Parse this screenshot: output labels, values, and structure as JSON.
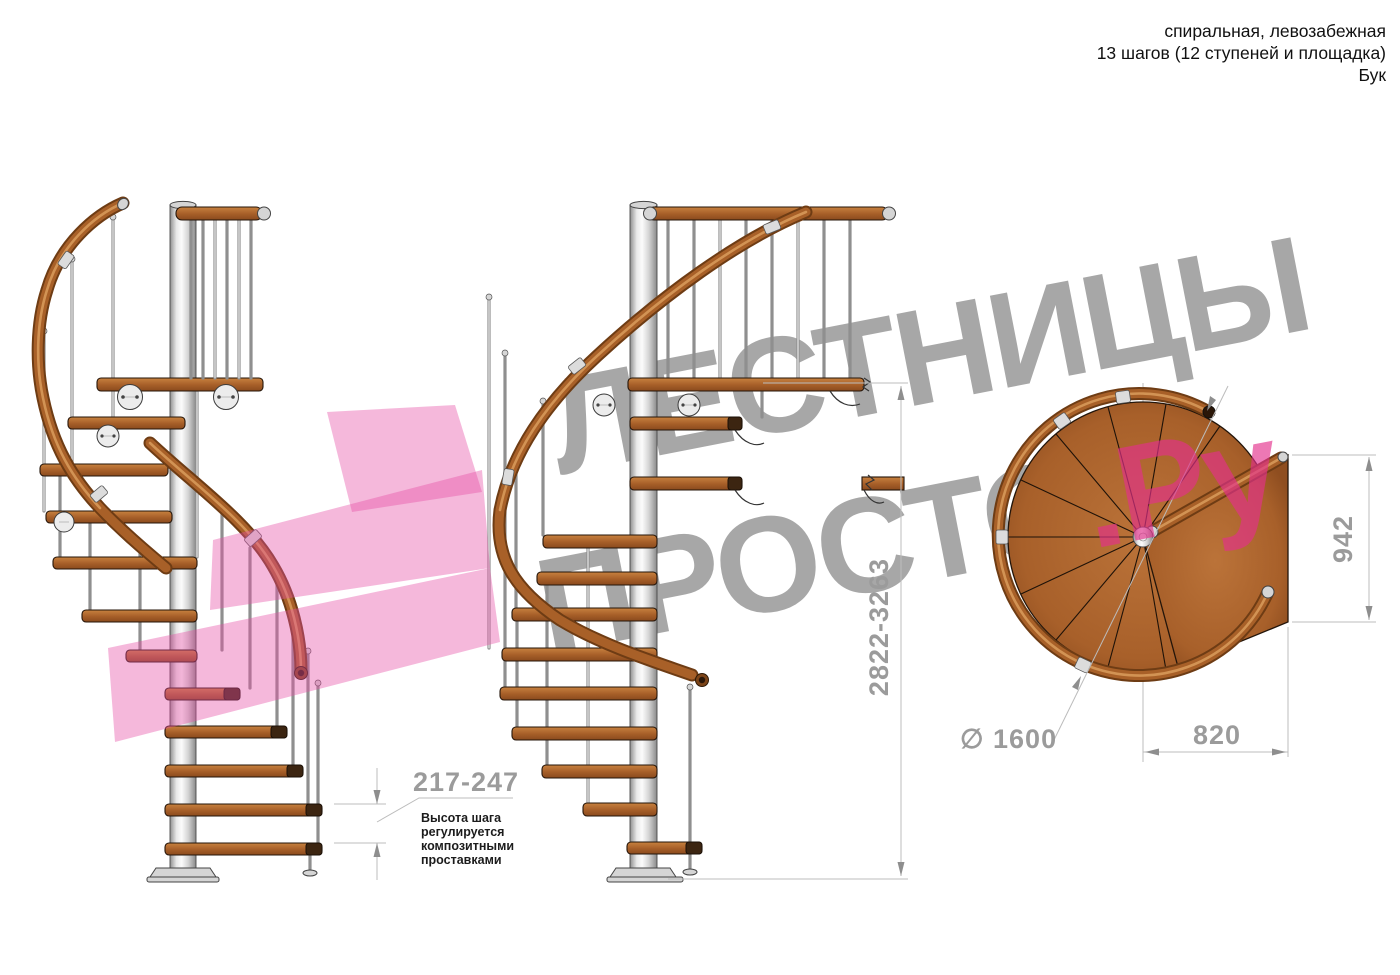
{
  "header": {
    "line1": "спиральная, левозабежная",
    "line2": "13 шагов (12 ступеней и площадка)",
    "line3": "Бук"
  },
  "watermark": {
    "line1": "ЛЕСТНИЦЫ",
    "line2_gray": "ПРОСТО",
    "line2_pink": ".Ру"
  },
  "dimensions": {
    "total_height": "2822-3263",
    "step_height": "217-247",
    "step_note_lines": [
      "Высота шага",
      "регулируется",
      "композитными",
      "проставками"
    ],
    "plan_width": "942",
    "plan_depth": "820",
    "diameter": "∅ 1600"
  },
  "colors": {
    "wood": "#a9632d",
    "metal": "#d9d9d9",
    "dimension_gray": "#9b9b9b",
    "watermark_gray": "#a8a8a8",
    "watermark_pink": "#ee7fb8",
    "background": "#ffffff"
  }
}
